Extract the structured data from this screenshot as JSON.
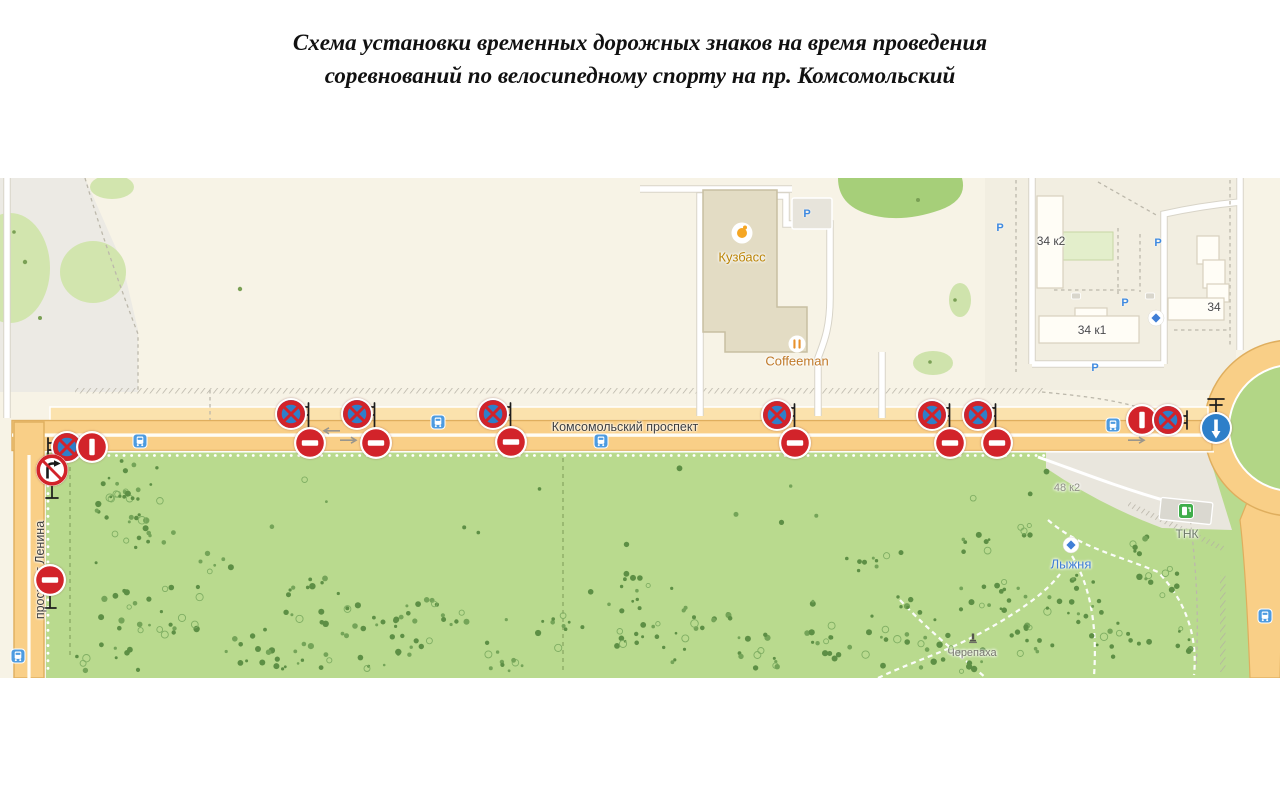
{
  "title": {
    "line1": "Схема установки временных дорожных знаков на время проведения",
    "line2": "соревнований по велосипедному спорту на пр. Комсомольский"
  },
  "map": {
    "colors": {
      "sign_red": "#d2232a",
      "sign_blue": "#2e7fc9",
      "pole_black": "#1c1c1c",
      "road_fill": "#f9cf87",
      "road_casing": "#dfae5e",
      "park_green": "#b9da8e",
      "bus_blue": "#4d9be0",
      "parking_blue": "#3f8ae0",
      "fuel_green": "#3fae4a",
      "poi_blue": "#3f7ed6"
    },
    "road_labels": [
      {
        "text": "Комсомольский проспект",
        "x": 625,
        "y": 427,
        "rot": 0
      },
      {
        "text": "проспект Ленина",
        "x": 40,
        "y": 570,
        "rot": -90
      }
    ],
    "poi_labels": [
      {
        "name": "kuzbass",
        "label": "Кузбасс",
        "x": 742,
        "y": 257,
        "icon": "venue",
        "icon_x": 742,
        "icon_y": 233,
        "color": "#bb8406",
        "size": 13
      },
      {
        "name": "coffeeman",
        "label": "Coffeeman",
        "x": 797,
        "y": 361,
        "icon": "food",
        "icon_x": 797,
        "icon_y": 344,
        "color": "#c07a2a",
        "size": 13
      },
      {
        "name": "tnk",
        "label": "ТНК",
        "x": 1187,
        "y": 534,
        "icon": "fuel",
        "icon_x": 1186,
        "icon_y": 511,
        "color": "#6d7a68",
        "size": 12
      },
      {
        "name": "lyzhnya",
        "label": "Лыжня",
        "x": 1071,
        "y": 564,
        "icon": "sight",
        "icon_x": 1071,
        "icon_y": 545,
        "color": "#3f7ed6",
        "size": 13
      },
      {
        "name": "cherepaha",
        "label": "Черепаха",
        "x": 972,
        "y": 653,
        "icon": "monument",
        "icon_x": 973,
        "icon_y": 639,
        "color": "#76766d",
        "size": 11
      },
      {
        "name": "house-48k2",
        "label": "48 к2",
        "x": 1067,
        "y": 488,
        "icon": "",
        "color": "#8e8e85",
        "size": 11
      },
      {
        "name": "house-34k2",
        "label": "34 к2",
        "x": 1051,
        "y": 241,
        "icon": "",
        "color": "#4a4a4a",
        "size": 12
      },
      {
        "name": "house-34k1",
        "label": "34 к1",
        "x": 1092,
        "y": 330,
        "icon": "",
        "color": "#4a4a4a",
        "size": 12
      },
      {
        "name": "house-34",
        "label": "34",
        "x": 1214,
        "y": 307,
        "icon": "",
        "color": "#4a4a4a",
        "size": 12
      },
      {
        "name": "poi-diamond",
        "label": "",
        "x": 1156,
        "y": 318,
        "icon": "sight",
        "icon_x": 1156,
        "icon_y": 318,
        "color": "#3f7ed6",
        "size": 11
      }
    ],
    "signs": [
      {
        "type": "no_stopping",
        "x": 291,
        "y": 414,
        "pole": "pair"
      },
      {
        "type": "no_entry",
        "x": 310,
        "y": 443
      },
      {
        "type": "no_stopping",
        "x": 357,
        "y": 414,
        "pole": "pair"
      },
      {
        "type": "no_entry",
        "x": 376,
        "y": 443
      },
      {
        "type": "no_stopping",
        "x": 493,
        "y": 414,
        "pole": "pair"
      },
      {
        "type": "no_entry",
        "x": 511,
        "y": 442
      },
      {
        "type": "no_stopping",
        "x": 777,
        "y": 415,
        "pole": "pair"
      },
      {
        "type": "no_entry",
        "x": 795,
        "y": 443
      },
      {
        "type": "no_stopping",
        "x": 932,
        "y": 415,
        "pole": "pair"
      },
      {
        "type": "no_entry",
        "x": 950,
        "y": 443
      },
      {
        "type": "no_stopping",
        "x": 978,
        "y": 415,
        "pole": "pair"
      },
      {
        "type": "no_entry",
        "x": 997,
        "y": 443
      },
      {
        "type": "no_stopping",
        "x": 67,
        "y": 447,
        "pole": "left"
      },
      {
        "type": "no_entry",
        "x": 92,
        "y": 447,
        "rot": 90
      },
      {
        "type": "no_right_turn",
        "x": 52,
        "y": 470,
        "pole": "below"
      },
      {
        "type": "no_entry",
        "x": 50,
        "y": 580,
        "pole": "below"
      },
      {
        "type": "no_entry",
        "x": 1142,
        "y": 420,
        "rot": 90
      },
      {
        "type": "no_stopping",
        "x": 1168,
        "y": 420,
        "pole": "right"
      },
      {
        "type": "go_straight",
        "x": 1216,
        "y": 428,
        "pole": "above"
      }
    ],
    "bus_stops": [
      [
        140,
        441
      ],
      [
        438,
        422
      ],
      [
        601,
        441
      ],
      [
        1113,
        425
      ],
      [
        1265,
        616
      ],
      [
        18,
        656
      ]
    ],
    "parking_marks": [
      [
        807,
        214
      ],
      [
        1000,
        228
      ],
      [
        1158,
        243
      ],
      [
        1125,
        303
      ],
      [
        1095,
        368
      ]
    ],
    "entrance_marks": [
      [
        1076,
        296
      ],
      [
        1150,
        296
      ]
    ]
  }
}
